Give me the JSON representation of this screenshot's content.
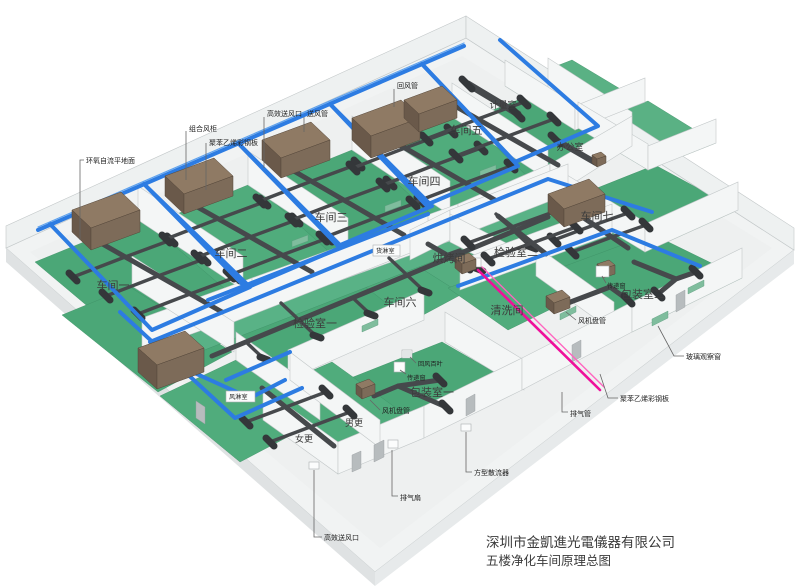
{
  "title": {
    "company": "深圳市金凱進光電儀器有限公司",
    "diagram": "五楼净化车间原理总图"
  },
  "rooms": {
    "workshop1": "车间一",
    "workshop2": "车间二",
    "workshop3": "车间三",
    "workshop4": "车间四",
    "workshop5": "车间五",
    "workshop6": "车间六",
    "workshop7": "车间七",
    "metering_room": "计量室",
    "office": "办公室",
    "inspection1": "检验室一",
    "inspection2": "检验室二",
    "baking_room": "烘烤间",
    "cleaning_room": "清洗间",
    "packing1": "包装室一",
    "packing2": "包装室二",
    "cargo_shower": "货淋室",
    "air_shower": "风淋室",
    "female_changing": "女更",
    "male_changing": "男更"
  },
  "annotations": {
    "epoxy_floor": "环氧自流平地面",
    "combined_ahu": "组合风柜",
    "polystyrene_panel_top": "聚苯乙烯彩钢板",
    "polystyrene_panel_right": "聚苯乙烯彩钢板",
    "hepa_outlet_top": "高效送风口",
    "hepa_outlet_bottom": "高效送风口",
    "supply_duct": "送风管",
    "return_duct": "回风管",
    "exhaust_duct": "排气管",
    "exhaust_fan": "排气扇",
    "square_diffuser": "方型散流器",
    "fan_coil_right": "风机盘管",
    "fan_coil_bottom": "风机盘管",
    "return_louver": "回风百叶",
    "pass_window_right": "传递窗",
    "pass_window_left": "传递窗",
    "glass_window": "玻璃观察窗"
  },
  "colors": {
    "supply_duct_blue": "#2d7ce2",
    "exhaust_duct_pink": "#ef109b",
    "floor_green": "#4ba777",
    "ahu_brown": "#7d6b59",
    "ceiling_duct_gray": "#46494c",
    "slab_white": "#f1f3f3"
  }
}
